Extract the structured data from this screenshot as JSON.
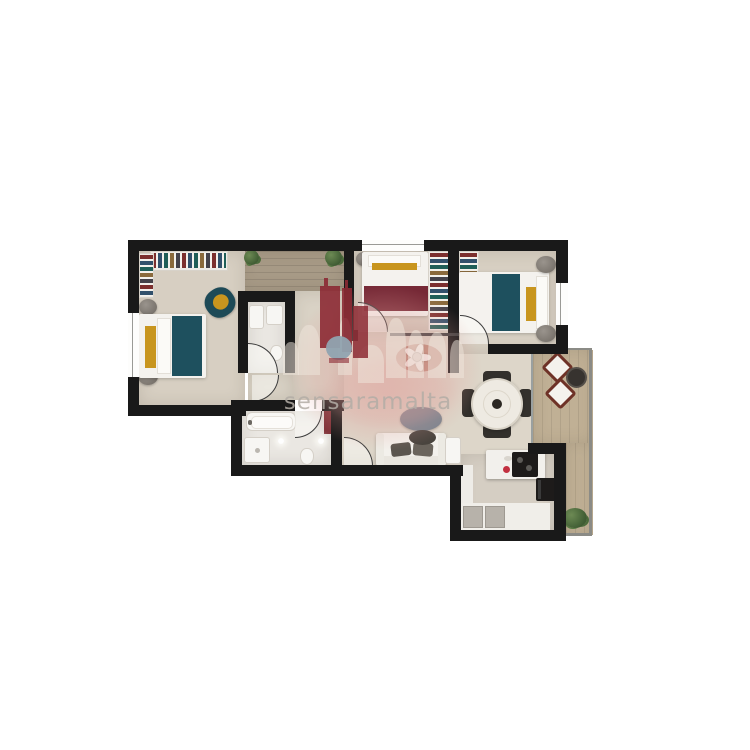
{
  "scene": {
    "type": "3d-rendered apartment floor plan, top-down view on white background",
    "background": "#ffffff",
    "rooms_visible_count": "3 bedrooms, 2 bathrooms, open living-dining-kitchen, hall, terrace"
  },
  "watermark": {
    "text": "sensaramalta",
    "text_color": "#b3ada6",
    "logo": {
      "skyline_color": "#8c2a34",
      "dome_color": "#90a3b0",
      "halo_color": "#e19d98"
    }
  },
  "palette": {
    "wall": "#191919",
    "floor_bedroom": "#d7cfc2",
    "floor_living": "#ddd6c9",
    "floor_bathroom": "#eae7e2",
    "floor_hall_wood": "#a79a86",
    "terrace_wood": "#c0b095",
    "bed_teal": "#1e505e",
    "bed_maroon": "#762936",
    "accent_yellow": "#c8951e",
    "armchair_teal": "#1d4a57",
    "sofa_white": "#f3f1ec",
    "chair_dark": "#33302c",
    "terrace_chair": "#6e3227",
    "plant_green": "#4a6b3a",
    "appliance_black": "#1d1b1a",
    "kettle_red": "#c23040",
    "coffee_table_gray": "#79848f",
    "wm_red": "#8c2a34",
    "wm_dome": "#90a3b0",
    "wm_text": "#b3ada6"
  }
}
